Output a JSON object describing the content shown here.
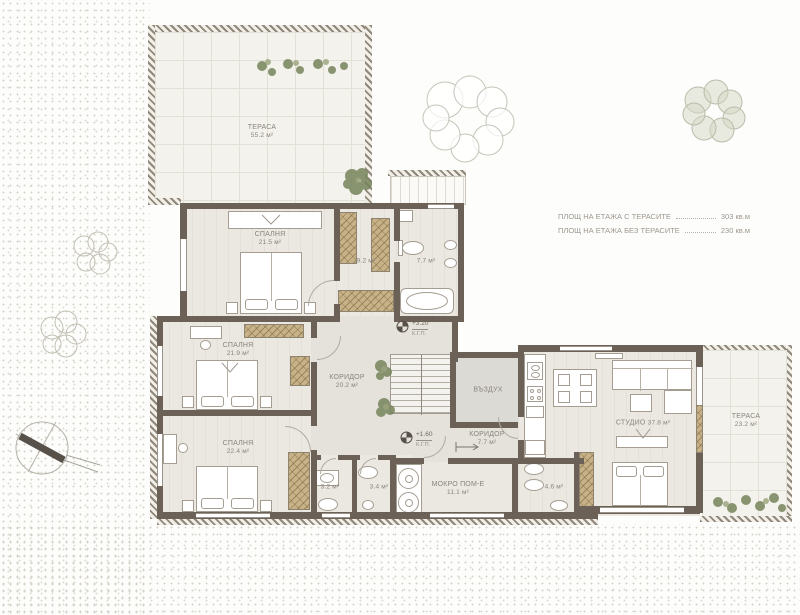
{
  "plan": {
    "rooms": {
      "terrace_nw": {
        "name": "ТЕРАСА",
        "area": "55.2 м²"
      },
      "bedroom_top": {
        "name": "СПАЛНЯ",
        "area": "21.5 м²"
      },
      "closet": {
        "area": "9.2 м²"
      },
      "bath_top": {
        "area": "7.7 м²"
      },
      "bedroom_mid": {
        "name": "СПАЛНЯ",
        "area": "21.9 м²"
      },
      "corridor_main": {
        "name": "КОРИДОР",
        "area": "20.2 м²"
      },
      "void": {
        "name": "ВЪЗДУХ"
      },
      "bedroom_low": {
        "name": "СПАЛНЯ",
        "area": "22.4 м²"
      },
      "wc_a": {
        "area": "3.2 м²"
      },
      "wc_b": {
        "area": "3.4 м²"
      },
      "corridor_small": {
        "name": "КОРИДОР",
        "area": "7.7 м²"
      },
      "wet_room": {
        "name": "МОКРО ПОМ-Е",
        "area": "11.1 м²"
      },
      "bath_small": {
        "area": "4.6 м²"
      },
      "studio": {
        "name": "СТУДИО",
        "area": "37.8 м²"
      },
      "terrace_e": {
        "name": "ТЕРАСА",
        "area": "23.2 м²"
      }
    },
    "levels": {
      "upper": {
        "value": "+3.20",
        "datum": "К.Г.П."
      },
      "lower": {
        "value": "+1.60",
        "datum": "К.Г.П."
      }
    },
    "legend": {
      "rows": [
        {
          "label": "ПЛОЩ НА ЕТАЖА С ТЕРАСИТЕ",
          "value": "303 кв.м"
        },
        {
          "label": "ПЛОЩ НА ЕТАЖА БЕЗ ТЕРАСИТЕ",
          "value": "230 кв.м"
        }
      ]
    },
    "colors": {
      "wall": "#6b6156",
      "wardrobe": "#c7b28a",
      "floor": "#ebe7e1",
      "terrace": "#f4f2ec",
      "plant": "#76835a",
      "label_text": "#89847c"
    }
  }
}
